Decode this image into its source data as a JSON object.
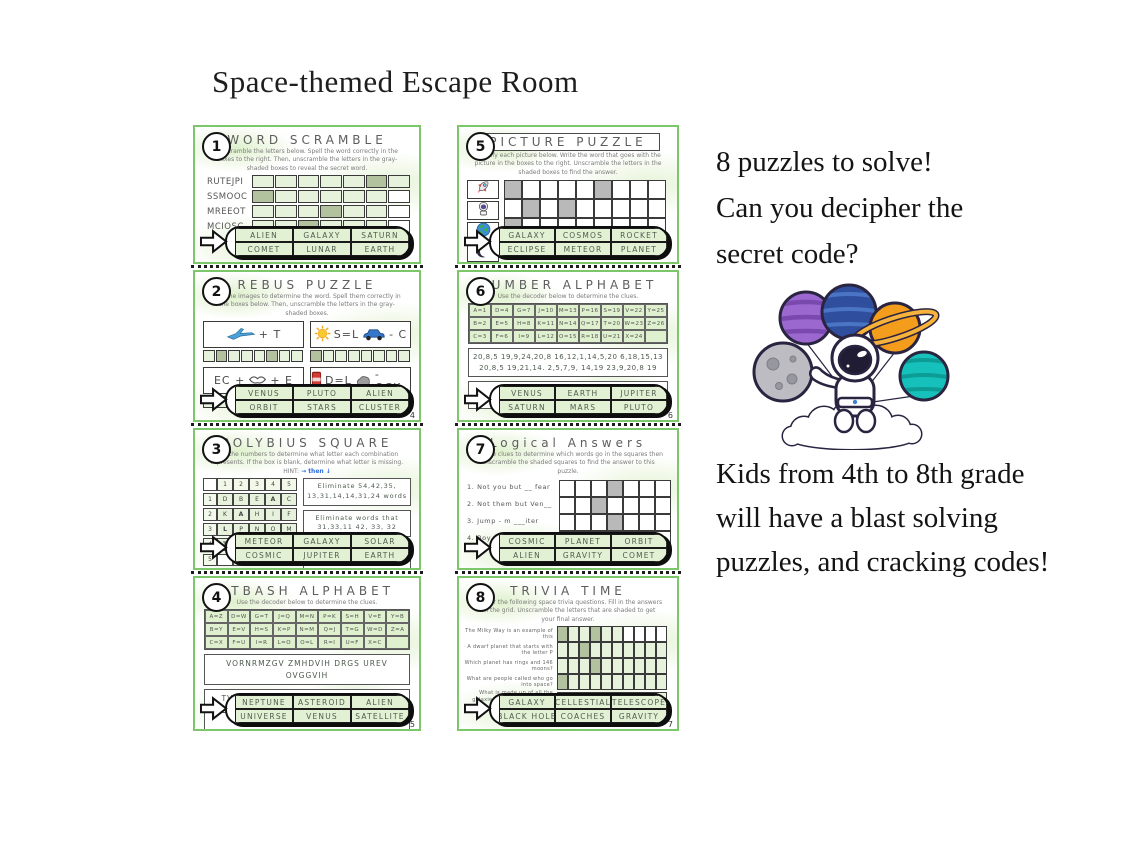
{
  "page": {
    "title": "Space-themed Escape Room"
  },
  "marketing": {
    "top_lines": [
      "8 puzzles to solve!",
      "Can you decipher the",
      "secret code?"
    ],
    "bottom_lines": [
      "Kids from 4th to 8th grade",
      "will have a blast solving",
      " puzzles, and cracking codes!"
    ]
  },
  "colors": {
    "card_border_green": "#7cc769",
    "cell_light_green": "#e7f2dc",
    "cell_shaded_green": "#b2c19e",
    "cell_shaded_gray": "#b9b9b9",
    "bank_cell_green": "#e2f1d3",
    "hint_arrow_blue": "#2f6fde"
  },
  "illustration": {
    "name": "astronaut-on-cloud-with-planet-balloons"
  },
  "cards": [
    {
      "number": "1",
      "title": "WORD SCRAMBLE",
      "title_boxed": false,
      "type": "word_scramble",
      "instructions": "Unscramble the letters below. Spell the word correctly in the boxes to the right. Then, unscramble the letters in the gray-shaded boxes to reveal the secret word.",
      "rows": [
        {
          "word": "RUTEJPI",
          "cells": 7,
          "shaded": [
            5
          ],
          "white": []
        },
        {
          "word": "SSMOOC",
          "cells": 7,
          "shaded": [
            0
          ],
          "white": [
            6
          ]
        },
        {
          "word": "MREEOT",
          "cells": 7,
          "shaded": [
            3
          ],
          "white": [
            6
          ]
        },
        {
          "word": "MCIOSC",
          "cells": 7,
          "shaded": [
            2
          ],
          "white": [
            6
          ]
        },
        {
          "word": "NALPTE",
          "cells": 7,
          "shaded": [
            4
          ],
          "white": [
            6
          ]
        }
      ],
      "answer_bank": [
        [
          "ALIEN",
          "GALAXY",
          "SATURN"
        ],
        [
          "COMET",
          "LUNAR",
          "EARTH"
        ]
      ],
      "page_number": ""
    },
    {
      "number": "2",
      "title": "REBUS PUZZLE",
      "title_boxed": false,
      "type": "rebus",
      "instructions": "Use the images to determine the word. Spell them correctly in the boxes below. Then, unscramble the letters in the gray-shaded boxes.",
      "items": [
        {
          "parts": [
            {
              "icon": "airplane"
            },
            {
              "text": "+ T"
            }
          ],
          "cells": 8,
          "shaded": [
            1,
            5
          ]
        },
        {
          "parts": [
            {
              "icon": "sun"
            },
            {
              "text": "S=L"
            },
            {
              "icon": "car"
            },
            {
              "text": "- C"
            }
          ],
          "cells": 8,
          "shaded": [
            0
          ]
        },
        {
          "parts": [
            {
              "text": "EC +"
            },
            {
              "icon": "lips"
            },
            {
              "text": "+ E"
            }
          ],
          "cells": 8,
          "shaded": [
            4
          ]
        },
        {
          "parts": [
            {
              "icon": "soda-can"
            },
            {
              "text": "D=L"
            },
            {
              "icon": "rock"
            },
            {
              "text": "- OCK"
            }
          ],
          "cells": 8,
          "shaded": []
        }
      ],
      "answer_bank": [
        [
          "VENUS",
          "PLUTO",
          "ALIEN"
        ],
        [
          "ORBIT",
          "STARS",
          "CLUSTER"
        ]
      ],
      "page_number": "4"
    },
    {
      "number": "3",
      "title": "POLYBIUS SQUARE",
      "title_boxed": false,
      "type": "polybius",
      "instructions": "Use the numbers to determine what letter each combination represents. If the box is blank, determine what letter is missing. HINT:",
      "hint_arrows": "→ then ↓",
      "header": [
        "",
        "1",
        "2",
        "3",
        "4",
        "5"
      ],
      "grid_rows": [
        {
          "label": "1",
          "letters": [
            "D",
            "B",
            "E",
            "A",
            "C"
          ]
        },
        {
          "label": "2",
          "letters": [
            "K",
            "A",
            "H",
            "I",
            "F"
          ]
        },
        {
          "label": "3",
          "letters": [
            "L",
            "P",
            "N",
            "O",
            "M"
          ]
        },
        {
          "label": "4",
          "letters": [
            "T",
            "R",
            "",
            "Q",
            "S"
          ]
        },
        {
          "label": "5",
          "letters": [
            "",
            "Z",
            "X",
            "V",
            "W"
          ]
        }
      ],
      "bold_cells": [
        [
          0,
          3
        ],
        [
          1,
          1
        ],
        [
          2,
          0
        ],
        [
          3,
          0
        ]
      ],
      "clues": [
        "Eliminate 54,42,35, 13,31,14,14,31,24 words",
        "Eliminate words that 31,33,11  42, 33, 32",
        "The answer does not 32,41,45,31  41,33  54"
      ],
      "answer_bank": [
        [
          "METEOR",
          "GALAXY",
          "SOLAR"
        ],
        [
          "COSMIC",
          "JUPITER",
          "EARTH"
        ]
      ],
      "page_number": ""
    },
    {
      "number": "4",
      "title": "ATBASH ALPHABET",
      "title_boxed": false,
      "type": "decoder_cipher",
      "instructions": "Use the decoder below to determine the clues.",
      "decoder": [
        [
          "A=Z",
          "D=W",
          "G=T",
          "J=Q",
          "M=N",
          "P=K",
          "S=H",
          "V=E",
          "Y=B"
        ],
        [
          "B=Y",
          "E=V",
          "H=S",
          "K=P",
          "N=M",
          "Q=J",
          "T=G",
          "W=D",
          "Z=A"
        ],
        [
          "C=X",
          "F=U",
          "I=R",
          "L=O",
          "O=L",
          "R=I",
          "U=F",
          "X=C",
          ""
        ]
      ],
      "cipher_lines": [
        "VORNRMZGV ZMHDVIH DRGS UREV OVGGVIH",
        "TVG IRW LU DLIWH GSZG VMW RM W",
        "XILHH LUU DLIWH DRGS F"
      ],
      "separate_boxes": true,
      "answer_box": false,
      "answer_bank": [
        [
          "NEPTUNE",
          "ASTEROID",
          "ALIEN"
        ],
        [
          "UNIVERSE",
          "VENUS",
          "SATELLITE"
        ]
      ],
      "page_number": "5"
    },
    {
      "number": "5",
      "title": "PICTURE PUZZLE",
      "title_boxed": true,
      "type": "picture",
      "instructions": "Identify each picture below.  Write the word that goes with the picture in the boxes to the right.  Unscramble the letters in the shaded boxes to find the answer.",
      "pictures": [
        "rocket",
        "astronaut",
        "earth",
        "moon"
      ],
      "grid": {
        "rows": 4,
        "cols": 9,
        "shaded": [
          [
            0,
            0
          ],
          [
            0,
            5
          ],
          [
            1,
            1
          ],
          [
            1,
            3
          ],
          [
            2,
            0
          ],
          [
            3,
            0
          ]
        ]
      },
      "answer_bank": [
        [
          "GALAXY",
          "COSMOS",
          "ROCKET"
        ],
        [
          "ECLIPSE",
          "METEOR",
          "PLANET"
        ]
      ],
      "page_number": ""
    },
    {
      "number": "6",
      "title": "NUMBER ALPHABET",
      "title_boxed": false,
      "type": "decoder_cipher",
      "instructions": "Use the decoder below to determine the clues.",
      "decoder": [
        [
          "A=1",
          "D=4",
          "G=7",
          "J=10",
          "M=13",
          "P=16",
          "S=19",
          "V=22",
          "Y=25"
        ],
        [
          "B=2",
          "E=5",
          "H=8",
          "K=11",
          "N=14",
          "Q=17",
          "T=20",
          "W=23",
          "Z=26"
        ],
        [
          "C=3",
          "F=6",
          "I=9",
          "L=12",
          "O=15",
          "R=18",
          "U=21",
          "X=24",
          ""
        ]
      ],
      "cipher_lines": [
        "20,8,5  19,9,24,20,8  16,12,1,14,5,20  6,18,15,13",
        "20,8,5  19,21,14.   2,5,7,9, 14,19  23,9,20,8  19"
      ],
      "separate_boxes": false,
      "answer_box": true,
      "answer_bank": [
        [
          "VENUS",
          "EARTH",
          "JUPITER"
        ],
        [
          "SATURN",
          "MARS",
          "PLUTO"
        ]
      ],
      "page_number": "6"
    },
    {
      "number": "7",
      "title": "Logical Answers",
      "title_boxed": false,
      "type": "logical",
      "instructions": "Use the clues to determine which words go in the squares then unscramble the shaded squares to find the answer to this puzzle.",
      "clues": [
        "1. Not you but __ fear",
        "2. Not them but Ven__",
        "3. Jump - m  ___iter",
        "4. Boy child - N __lar"
      ],
      "grid": {
        "rows": 4,
        "cols": 7,
        "shaded": [
          [
            0,
            3
          ],
          [
            1,
            2
          ],
          [
            2,
            3
          ],
          [
            3,
            2
          ],
          [
            3,
            3
          ]
        ]
      },
      "answer_bank": [
        [
          "COSMIC",
          "PLANET",
          "ORBIT"
        ],
        [
          "ALIEN",
          "GRAVITY",
          "COMET"
        ]
      ],
      "page_number": ""
    },
    {
      "number": "8",
      "title": "TRIVIA TIME",
      "title_boxed": false,
      "type": "trivia",
      "instructions": "Answer the following space trivia questions.  Fill in the answers on the grid.  Unscramble the letters that are shaded to get your final answer.",
      "questions": [
        "The Milky Way is an example of this",
        "A dwarf planet that starts with the letter P",
        "Which planet has rings and 146 moons?",
        "What are people called who go into space?",
        "What is made up of all the galaxies, nebulae, stars, and planets"
      ],
      "grid": {
        "cols": 10,
        "rows": [
          {
            "shaded": [
              0,
              3
            ],
            "white": [
              6,
              7,
              8,
              9
            ]
          },
          {
            "shaded": [
              2
            ],
            "white": []
          },
          {
            "shaded": [
              3
            ],
            "white": []
          },
          {
            "shaded": [
              0
            ],
            "white": []
          },
          {
            "shaded": [
              2,
              5
            ],
            "white": []
          }
        ]
      },
      "answer_bank": [
        [
          "GALAXY",
          "CELLESTIAL",
          "TELESCOPE"
        ],
        [
          "BLACK HOLE",
          "COACHES",
          "GRAVITY"
        ]
      ],
      "page_number": "7"
    }
  ]
}
